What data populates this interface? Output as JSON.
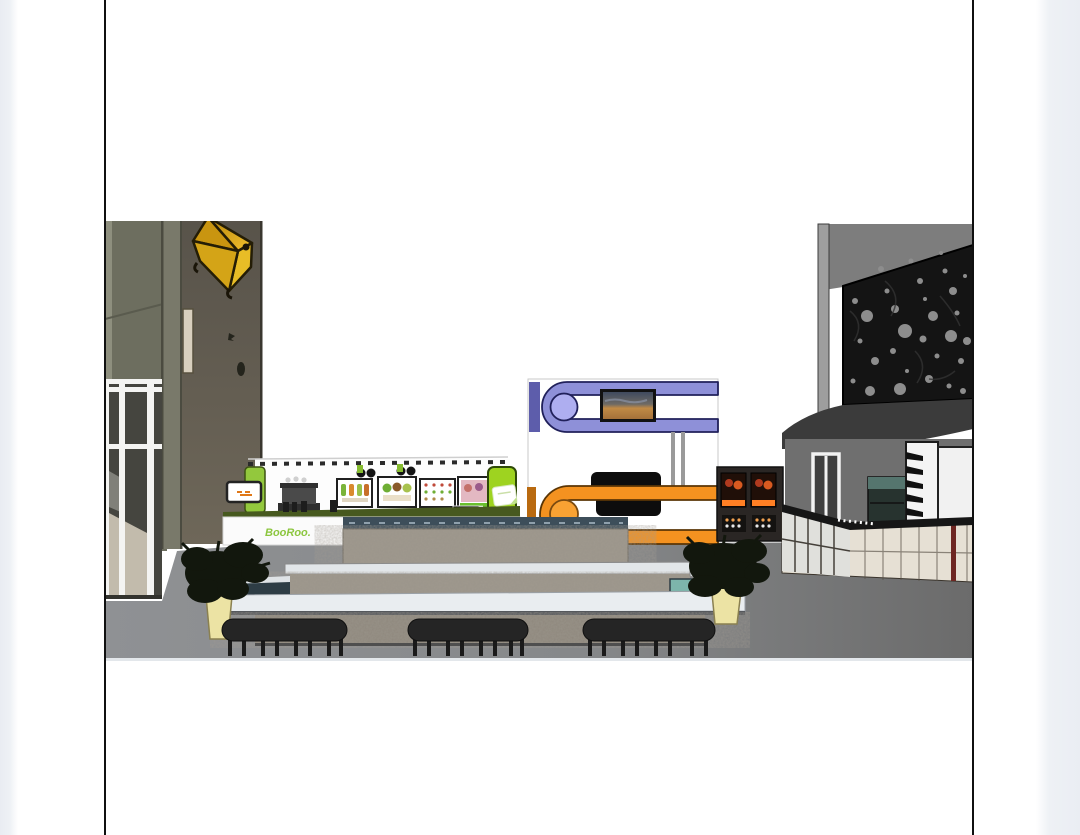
{
  "viewer": {
    "page_background": "#ffffff",
    "page_border_color": "#101010",
    "edge_strip_color": "#eef1f5"
  },
  "artwork": {
    "description": "3D elevation rendering of a mall food-court: juice kiosk, two-tone media kiosk, coffee vending machines, curved cafe counter, perforated facade, tiered stone fountain with stools",
    "kiosk": {
      "brand_text": "BooRoo.",
      "accent_green": "#9ed320",
      "counter_band_green": "#47591f",
      "menu_boards": 4
    },
    "media_kiosk": {
      "upper_band_color": "#8e90d8",
      "upper_circle_color": "#aeaef0",
      "lower_band_color": "#f49220",
      "lower_circle_color": "#f9a233",
      "tv_screens": 2
    },
    "left_building": {
      "wall_color": "#665f51",
      "star_color": "#e8bd26",
      "storefront": "white-framed glass"
    },
    "right_building": {
      "facade": "black perforated screen with circular holes",
      "counter_cream": "#e6e0d4",
      "red_stripe": "#6e2622"
    },
    "fountain": {
      "material": "granite",
      "coping_color": "#e9edf0",
      "cap_color": "#3d4e5a",
      "water_color": "#7db5ab"
    },
    "floor_color_left": "#8f9194",
    "floor_color_right": "#6b6b6b",
    "stools": 3,
    "planters": 2,
    "vending_machines": 2
  }
}
